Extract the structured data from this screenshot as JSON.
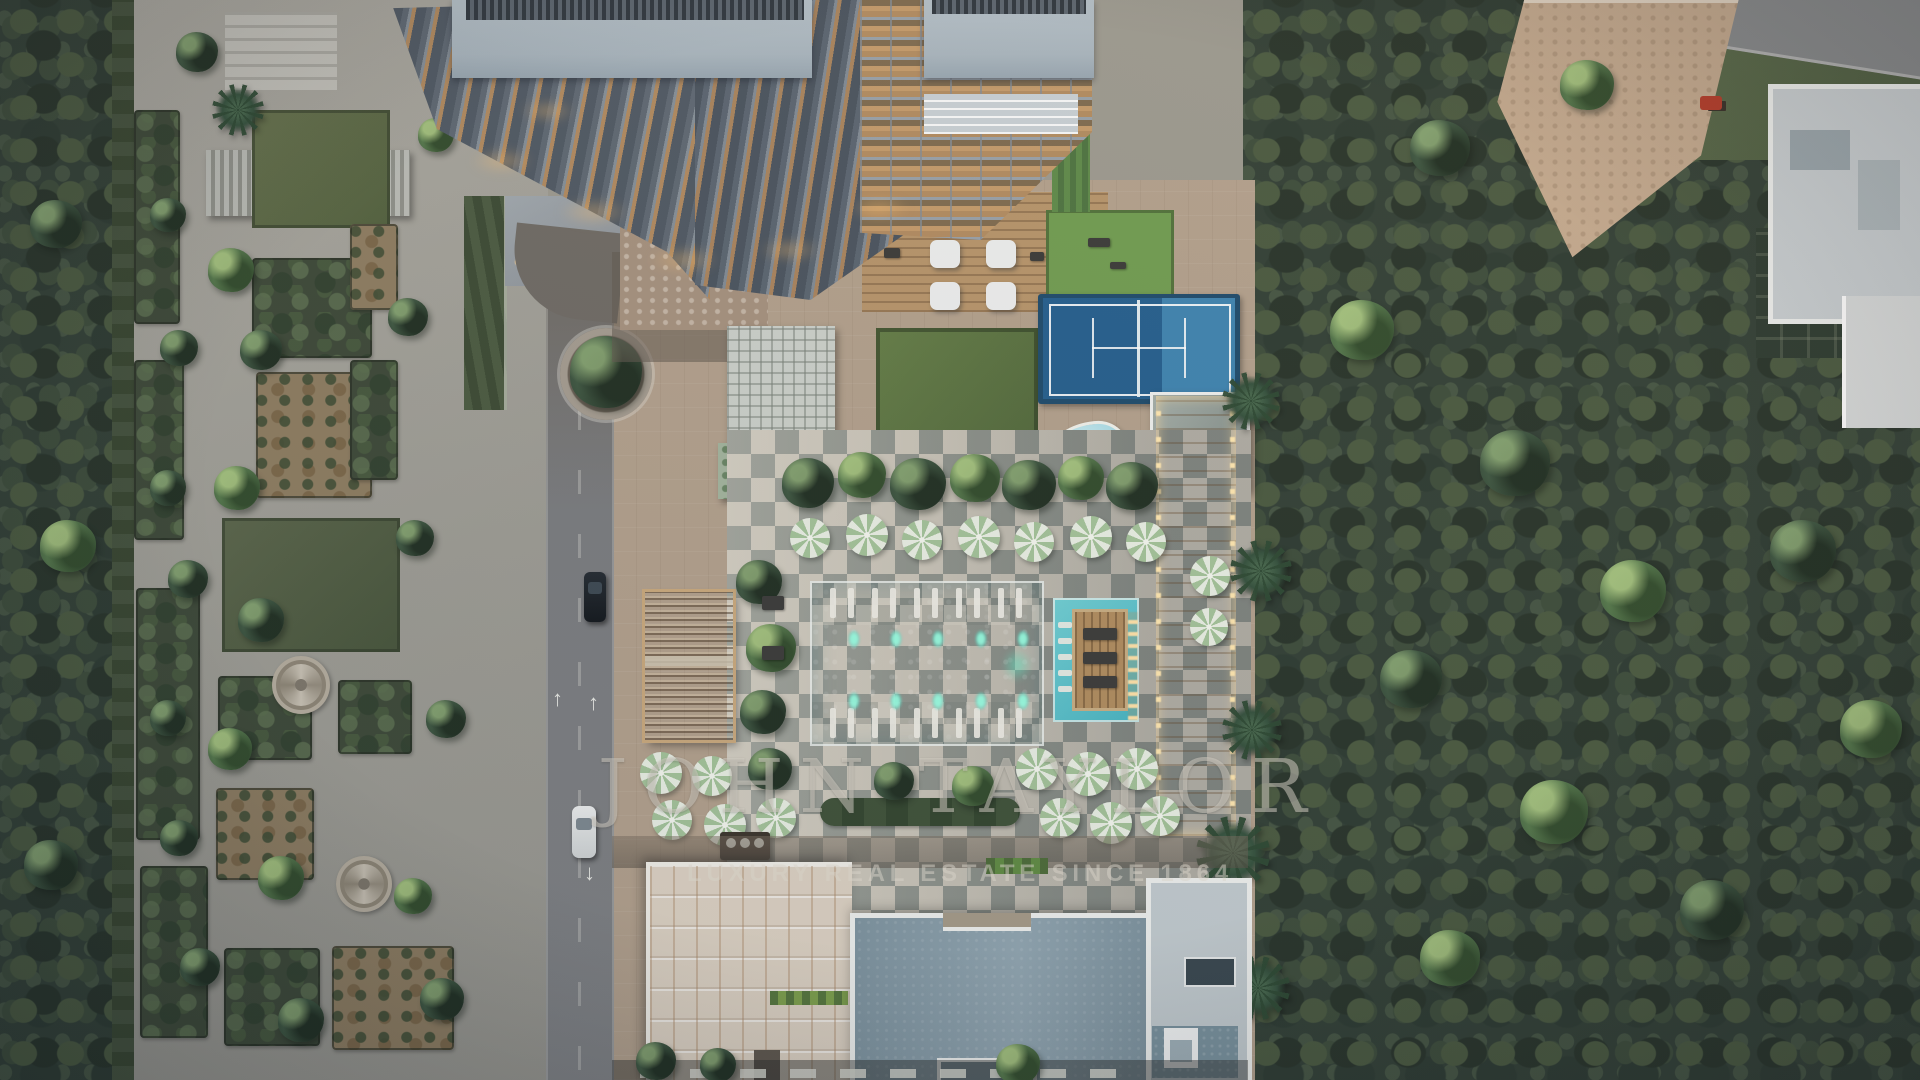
{
  "watermark": {
    "title": "JOHN TAYLOR",
    "tagline": "LUXURY REAL ESTATE SINCE 1864"
  },
  "palette": {
    "forest": "#313f35",
    "plaza": "#a5a49d",
    "road": "#77797b",
    "deck_paving": "#b2a08c",
    "checker_light": "#c9c4b8",
    "checker_dark": "#8e938c",
    "pool_water": "#55c4cd",
    "pool_deep": "#3fb0c0",
    "pool_glow": "#7df2d9",
    "tennis_dark": "#235e8d",
    "tennis_light": "#3d83b0",
    "kids_pool": "#a9dce6",
    "wood": "#b2905f",
    "walkway_lit": "#c2a478",
    "cream_roof": "#ddd2c3",
    "slate_roof": "#8aa0ac",
    "white_trim": "#eef0ee",
    "lawn": "#5f7a47",
    "lawn_bright": "#6f9c50",
    "umbrella_green": "#a3c399",
    "umbrella_white": "#e9efe4",
    "balcony_wood": "#b0895e",
    "balcony_slab": "#5d6772",
    "glass_roof": "#a7b4bd",
    "watermark": "rgba(228,222,210,0.5)"
  }
}
